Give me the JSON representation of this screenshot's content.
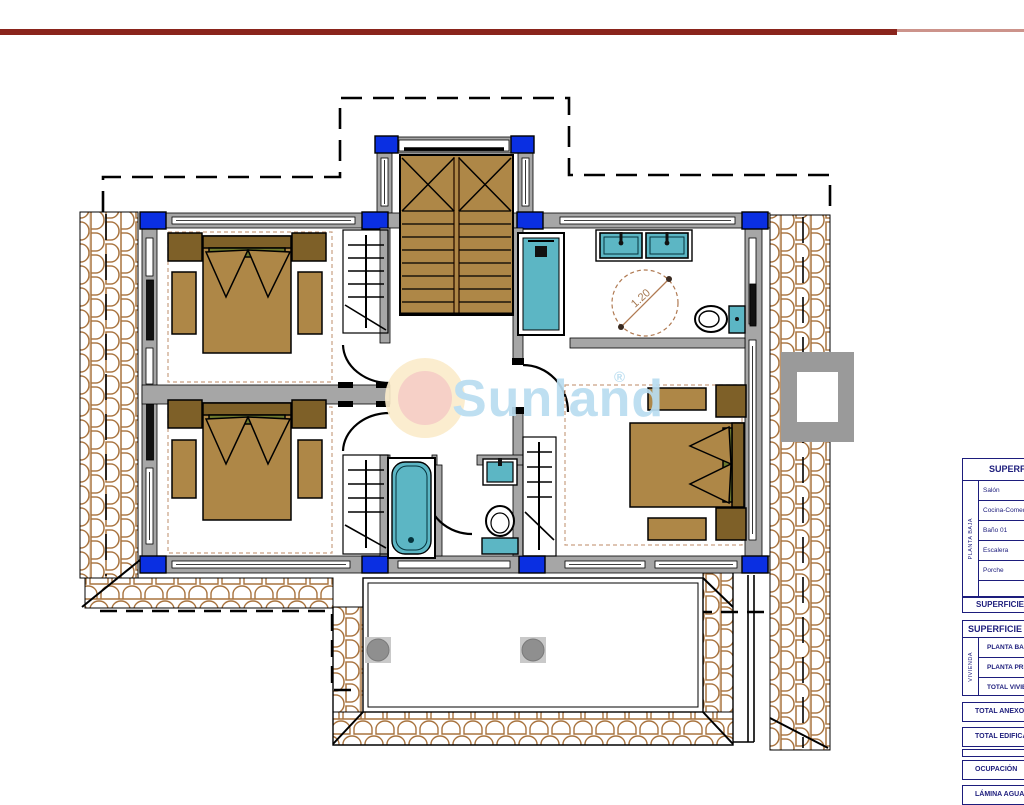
{
  "header": {
    "rule_dark": "#8a241c",
    "rule_light": "#cc938b"
  },
  "watermark": {
    "name": "Sunland",
    "registered": "®",
    "color": "#b9ddf0"
  },
  "plan": {
    "turning_circle_label": "1.20",
    "colors": {
      "wall": "#a6a6a6",
      "pillar": "#0a2fe2",
      "wood": "#ae8747",
      "wood_dark": "#7e6028",
      "fixture": "#5cb6c4",
      "tile": "#a8733e",
      "annotation": "#a4764e"
    }
  },
  "panel": {
    "text_color": "#1d1d7c",
    "table_upper": {
      "title": "SUPERFICIES",
      "group_label": "PLANTA BAJA",
      "rows": [
        "Salón",
        "Cocina-Comedor",
        "Baño 01",
        "Escalera",
        "Porche",
        ""
      ],
      "footer": "SUPERFICIE"
    },
    "table_lower": {
      "title": "SUPERFICIE",
      "group_label": "VIVIENDA",
      "rows": [
        "PLANTA BAJA",
        "PLANTA PRIMERA",
        "TOTAL VIVIENDA"
      ],
      "bands": [
        "TOTAL ANEXOS",
        "TOTAL EDIFICACIÓN",
        "",
        "OCUPACIÓN",
        "LÁMINA AGUA"
      ]
    }
  }
}
